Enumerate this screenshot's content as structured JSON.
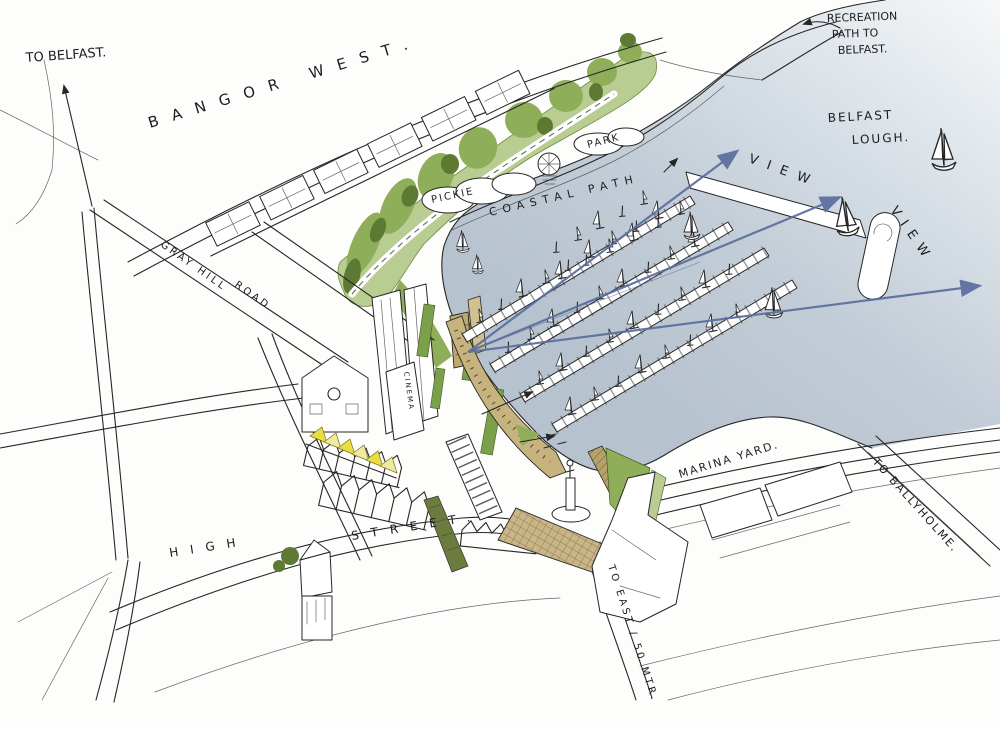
{
  "title": "Bangor marina waterfront concept sketch",
  "labels": {
    "to_belfast": "TO BELFAST.",
    "bangor_west": "BANGOR WEST.",
    "recreation_1": "RECREATION",
    "recreation_2": "PATH TO",
    "recreation_3": "BELFAST.",
    "lough_1": "BELFAST",
    "lough_2": "LOUGH.",
    "view_1": "VIEW",
    "view_2": "VIEW",
    "gray_hill": "GRAY HILL",
    "road": "ROAD",
    "pickie": "PICKIE",
    "park": "PARK",
    "coastal_path": "COASTAL PATH",
    "cinema": "CINEMA",
    "marina_yard": "MARINA YARD.",
    "to_ballyholme": "TO BALLYHOLME.",
    "high": "HIGH",
    "street": "STREET.",
    "to_east": "TO EAST / 50 MTR."
  },
  "colors": {
    "ink": "#262626",
    "water_deep": "#b6c2ce",
    "water_light": "#f4f7f8",
    "green_light": "#b9cc92",
    "green_mid": "#8fae5a",
    "green_dark": "#5d7a33",
    "olive": "#6b7c3e",
    "yellow": "#e8de3f",
    "yellow_pale": "#efeaa0",
    "tan": "#c7b37e",
    "tan_dark": "#bfa96f",
    "arrow_blue": "#5a6e9e"
  }
}
